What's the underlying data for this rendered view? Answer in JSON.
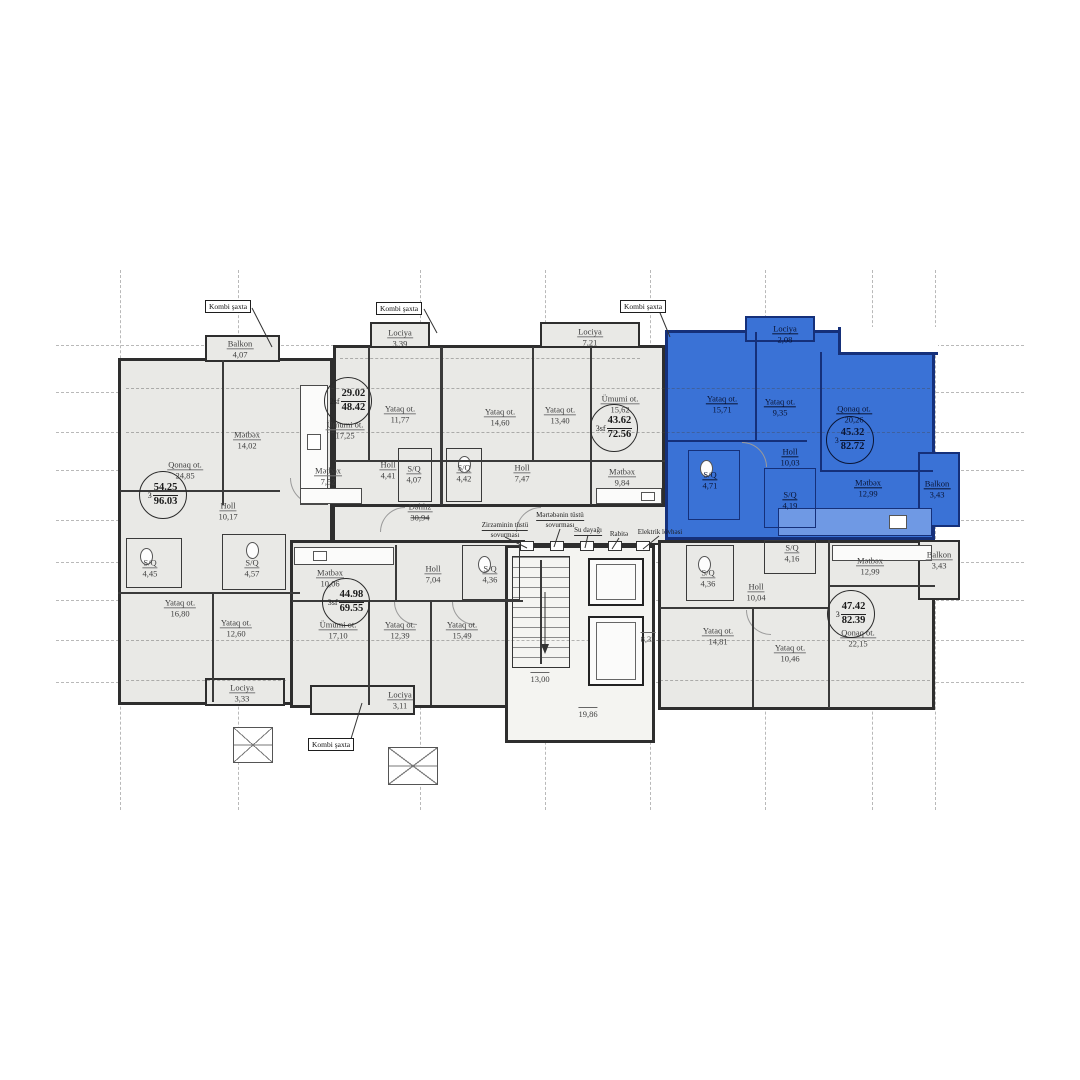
{
  "plan": {
    "shaft_label": "Kombi şaxta",
    "corridor": {
      "name": "Dəhliz",
      "area": "30,94"
    },
    "core": {
      "stair_width": "13,00",
      "lift_width": "8,32",
      "core_width": "19,86"
    },
    "utilities": {
      "basement_vent_l1": "Zirzəminin tüstü",
      "basement_vent_l2": "sovurması",
      "floor_vent_l1": "Mərtəbənin tüstü",
      "floor_vent_l2": "sovurması",
      "water_riser": "Su dayağı",
      "comms": "Rabitə",
      "electric_board": "Elektrik lövhəsi"
    },
    "apartments": [
      {
        "id": "apt-96-03",
        "highlighted": false,
        "badge": {
          "prefix": "3",
          "net": "54.25",
          "gross": "96.03"
        },
        "rooms": [
          {
            "name": "Balkon",
            "area": "4,07"
          },
          {
            "name": "Qonaq ot.",
            "area": "24,85"
          },
          {
            "name": "Mətbəx",
            "area": "14,02"
          },
          {
            "name": "Holl",
            "area": "10,17"
          },
          {
            "name": "S/Q",
            "area": "4,45"
          },
          {
            "name": "S/Q",
            "area": "4,57"
          },
          {
            "name": "Yataq ot.",
            "area": "16,80"
          },
          {
            "name": "Yataq ot.",
            "area": "12,60"
          },
          {
            "name": "Lociya",
            "area": "3,33"
          }
        ]
      },
      {
        "id": "apt-48-42",
        "highlighted": false,
        "badge": {
          "prefix": "2sf",
          "net": "29.02",
          "gross": "48.42"
        },
        "rooms": [
          {
            "name": "Lociya",
            "area": "3,39"
          },
          {
            "name": "Ümumi ot.",
            "area": "17,25"
          },
          {
            "name": "Yataq ot.",
            "area": "11,77"
          },
          {
            "name": "Mətbəx",
            "area": "7,52"
          },
          {
            "name": "Holl",
            "area": "4,41"
          },
          {
            "name": "S/Q",
            "area": "4,07"
          }
        ]
      },
      {
        "id": "apt-72-56",
        "highlighted": false,
        "badge": {
          "prefix": "3sf",
          "net": "43.62",
          "gross": "72.56"
        },
        "rooms": [
          {
            "name": "Yataq ot.",
            "area": "14,60"
          },
          {
            "name": "Yataq ot.",
            "area": "13,40"
          },
          {
            "name": "Lociya",
            "area": "7,21"
          },
          {
            "name": "Ümumi ot.",
            "area": "15,62"
          },
          {
            "name": "Mətbəx",
            "area": "9,84"
          },
          {
            "name": "Holl",
            "area": "7,47"
          },
          {
            "name": "S/Q",
            "area": "4,42"
          }
        ]
      },
      {
        "id": "apt-82-72",
        "highlighted": true,
        "badge": {
          "prefix": "3",
          "net": "45.32",
          "gross": "82.72"
        },
        "rooms": [
          {
            "name": "Lociya",
            "area": "2,08"
          },
          {
            "name": "Yataq ot.",
            "area": "15,71"
          },
          {
            "name": "Yataq ot.",
            "area": "9,35"
          },
          {
            "name": "Qonaq ot.",
            "area": "20,26"
          },
          {
            "name": "Holl",
            "area": "10,03"
          },
          {
            "name": "S/Q",
            "area": "4,71"
          },
          {
            "name": "S/Q",
            "area": "4,19"
          },
          {
            "name": "Mətbəx",
            "area": "12,99"
          },
          {
            "name": "Balkon",
            "area": "3,43"
          }
        ]
      },
      {
        "id": "apt-69-55",
        "highlighted": false,
        "badge": {
          "prefix": "3sf",
          "net": "44.98",
          "gross": "69.55"
        },
        "rooms": [
          {
            "name": "Mətbəx",
            "area": "10,06"
          },
          {
            "name": "Ümumi ot.",
            "area": "17,10"
          },
          {
            "name": "Yataq ot.",
            "area": "12,39"
          },
          {
            "name": "Yataq ot.",
            "area": "15,49"
          },
          {
            "name": "Holl",
            "area": "7,04"
          },
          {
            "name": "S/Q",
            "area": "4,36"
          },
          {
            "name": "Lociya",
            "area": "3,11"
          }
        ]
      },
      {
        "id": "apt-82-39",
        "highlighted": false,
        "badge": {
          "prefix": "3",
          "net": "47.42",
          "gross": "82.39"
        },
        "rooms": [
          {
            "name": "S/Q",
            "area": "4,16"
          },
          {
            "name": "S/Q",
            "area": "4,36"
          },
          {
            "name": "Holl",
            "area": "10,04"
          },
          {
            "name": "Mətbəx",
            "area": "12,99"
          },
          {
            "name": "Balkon",
            "area": "3,43"
          },
          {
            "name": "Qonaq ot.",
            "area": "22,15"
          },
          {
            "name": "Yataq ot.",
            "area": "14,81"
          },
          {
            "name": "Yataq ot.",
            "area": "10,46"
          }
        ]
      }
    ]
  }
}
